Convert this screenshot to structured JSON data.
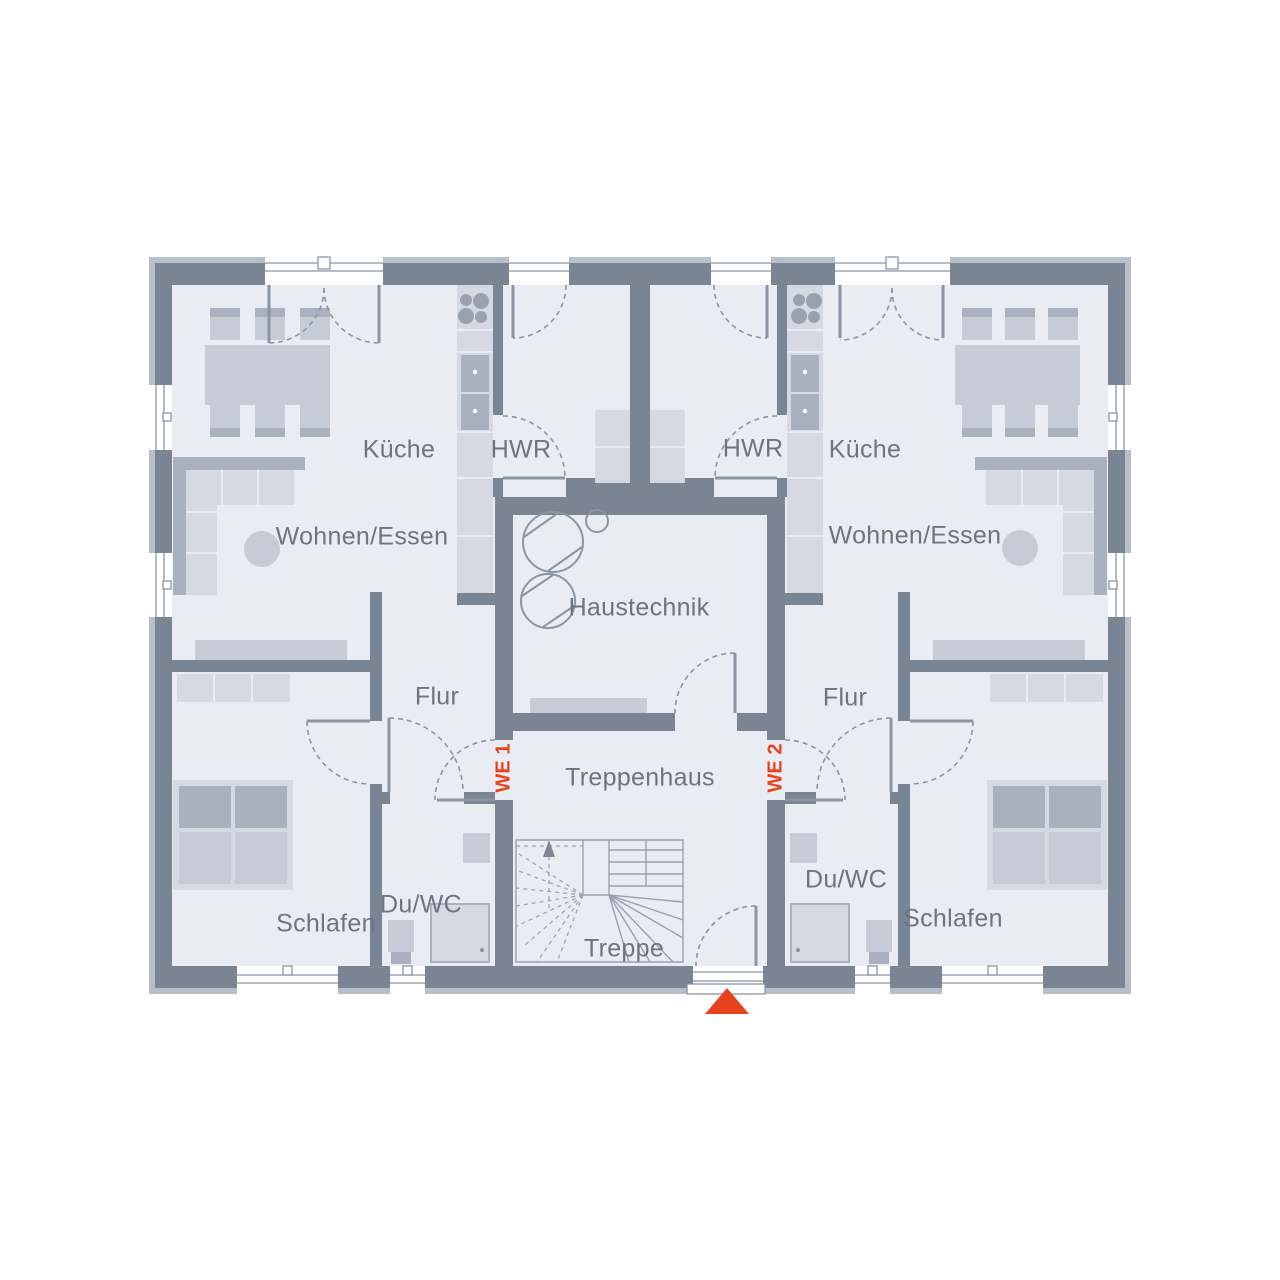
{
  "plan": {
    "labels": {
      "kueche": "Küche",
      "hwr": "HWR",
      "wohnen_essen": "Wohnen/Essen",
      "flur": "Flur",
      "schlafen": "Schlafen",
      "du_wc": "Du/WC",
      "haustechnik": "Haustechnik",
      "treppenhaus": "Treppenhaus",
      "treppe": "Treppe",
      "we1": "WE 1",
      "we2": "WE 2"
    },
    "colors": {
      "wall": "#7a8594",
      "wall_trim": "#b7bfc9",
      "floor": "#e9edf3",
      "furniture_light": "#d5dae2",
      "furniture_mid": "#c6ccd6",
      "furniture_dark": "#a9b1bf",
      "line": "#8b94a3",
      "text": "#6b7480",
      "accent": "#e8431c",
      "background": "#ffffff"
    },
    "markers": {
      "entrance": "entrance-triangle"
    }
  }
}
